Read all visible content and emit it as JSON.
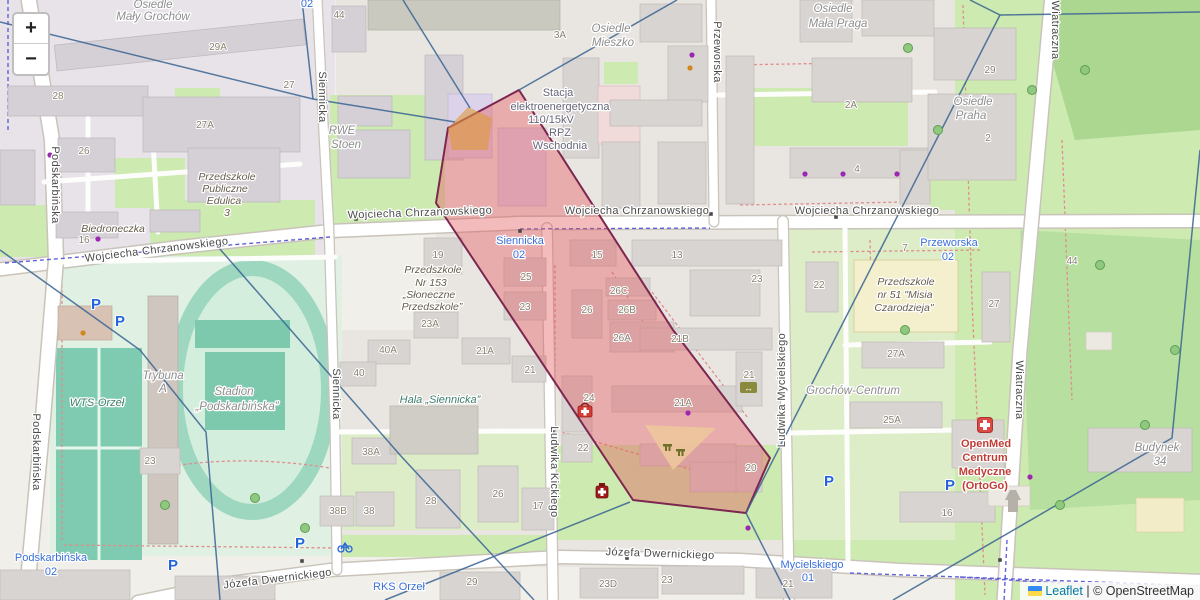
{
  "controls": {
    "zoom_in": "+",
    "zoom_out": "−"
  },
  "attribution": {
    "leaflet": "Leaflet",
    "sep": "|",
    "osm": "© OpenStreetMap"
  },
  "overlay": {
    "region_fill": "#e4555a",
    "region_stroke": "#7c2650",
    "region_opacity": "0.40",
    "region_points": "519,90 673,330 770,458 746,513 633,500 436,203 448,128",
    "orange_patch_points": "448,128 468,107 492,118 488,150 452,150",
    "orange_patch_fill": "#dd9a3a",
    "playground_points": "645,425 716,428 673,470",
    "playground_fill": "#edc79b",
    "voronoi_color": "#3e6793",
    "voronoi_lines": [
      "M302,0 L313,99",
      "M0,22 L313,99 L455,122",
      "M403,0 L470,108",
      "M677,0 L519,90",
      "M0,250 L140,350 L206,432 L220,600",
      "M212,240 L400,455 L534,600",
      "M630,502 L385,600",
      "M970,0 L1000,15 L1200,12",
      "M1000,15 L746,513",
      "M746,513 L790,600",
      "M1200,150 L1172,438 L893,600"
    ]
  },
  "map": {
    "labels": [
      {
        "t": "Wojciecha Chrzanowskiego",
        "x": 157,
        "y": 253,
        "c": "street",
        "r": -7
      },
      {
        "t": "Wojciecha Chrzanowskiego",
        "x": 420,
        "y": 216,
        "c": "street",
        "r": -2
      },
      {
        "t": "Wojciecha Chrzanowskiego",
        "x": 637,
        "y": 214,
        "c": "street"
      },
      {
        "t": "Wojciecha Chrzanowskiego",
        "x": 867,
        "y": 214,
        "c": "street"
      },
      {
        "t": "Józefa Dwernickiego",
        "x": 278,
        "y": 582,
        "c": "street",
        "r": -7
      },
      {
        "t": "Józefa Dwernickiego",
        "x": 660,
        "y": 557,
        "c": "street",
        "r": 2
      },
      {
        "t": "Podskarbińska",
        "x": 52,
        "y": 185,
        "c": "street",
        "r": 90
      },
      {
        "t": "Podskarbińska",
        "x": 33,
        "y": 452,
        "c": "street",
        "r": 90
      },
      {
        "t": "Siennicka",
        "x": 319,
        "y": 97,
        "c": "street",
        "r": 90
      },
      {
        "t": "Siennicka",
        "x": 333,
        "y": 394,
        "c": "street",
        "r": 90
      },
      {
        "t": "Ludwika Kickiego",
        "x": 551,
        "y": 472,
        "c": "street",
        "r": 90
      },
      {
        "t": "Ludwika Mycielskiego",
        "x": 785,
        "y": 390,
        "c": "street",
        "r": -90
      },
      {
        "t": "Przeworska",
        "x": 714,
        "y": 52,
        "c": "street",
        "r": 90
      },
      {
        "t": "Wiatraczna",
        "x": 1052,
        "y": 30,
        "c": "street",
        "r": 90
      },
      {
        "t": "Wiatraczna",
        "x": 1016,
        "y": 390,
        "c": "street",
        "r": 90
      },
      {
        "t": "Osiedle",
        "x": 153,
        "y": 8,
        "c": "area"
      },
      {
        "t": "Mały Grochów",
        "x": 153,
        "y": 20,
        "c": "area"
      },
      {
        "t": "Osiedle",
        "x": 611,
        "y": 32,
        "c": "area"
      },
      {
        "t": "Mieszko",
        "x": 613,
        "y": 46,
        "c": "area"
      },
      {
        "t": "Osiedle",
        "x": 833,
        "y": 12,
        "c": "area"
      },
      {
        "t": "Mała Praga",
        "x": 838,
        "y": 27,
        "c": "area"
      },
      {
        "t": "Osiedle",
        "x": 973,
        "y": 105,
        "c": "area"
      },
      {
        "t": "Praha",
        "x": 971,
        "y": 119,
        "c": "area"
      },
      {
        "t": "Grochów-Centrum",
        "x": 853,
        "y": 394,
        "c": "area"
      },
      {
        "t": "Trybuna",
        "x": 163,
        "y": 379,
        "c": "area"
      },
      {
        "t": "A",
        "x": 163,
        "y": 392,
        "c": "area"
      },
      {
        "t": "Budynek",
        "x": 1157,
        "y": 451,
        "c": "area"
      },
      {
        "t": "34",
        "x": 1160,
        "y": 465,
        "c": "area"
      },
      {
        "t": "RWE",
        "x": 342,
        "y": 134,
        "c": "area"
      },
      {
        "t": "Stoen",
        "x": 346,
        "y": 148,
        "c": "area"
      },
      {
        "t": "Stadion",
        "x": 234,
        "y": 395,
        "c": "area"
      },
      {
        "t": "„Podskarbińska”",
        "x": 237,
        "y": 410,
        "c": "area"
      },
      {
        "t": "Stacja",
        "x": 558,
        "y": 96,
        "c": "power"
      },
      {
        "t": "elektroenergetyczna",
        "x": 560,
        "y": 110,
        "c": "power"
      },
      {
        "t": "110/15kV",
        "x": 551,
        "y": 123,
        "c": "power"
      },
      {
        "t": "RPZ",
        "x": 560,
        "y": 136,
        "c": "power"
      },
      {
        "t": "Wschodnia",
        "x": 560,
        "y": 149,
        "c": "power"
      },
      {
        "t": "WTS-Orzeł",
        "x": 97,
        "y": 406,
        "c": "sport"
      },
      {
        "t": "Hala „Siennicka”",
        "x": 440,
        "y": 403,
        "c": "sport"
      },
      {
        "t": "Przedszkole",
        "x": 227,
        "y": 180,
        "c": "school"
      },
      {
        "t": "Publiczne",
        "x": 225,
        "y": 192,
        "c": "school"
      },
      {
        "t": "Edulica",
        "x": 224,
        "y": 204,
        "c": "school"
      },
      {
        "t": "3",
        "x": 227,
        "y": 216,
        "c": "school"
      },
      {
        "t": "Przedszkole",
        "x": 433,
        "y": 273,
        "c": "school"
      },
      {
        "t": "Nr 153",
        "x": 431,
        "y": 286,
        "c": "school"
      },
      {
        "t": "„Słoneczne",
        "x": 429,
        "y": 298,
        "c": "school"
      },
      {
        "t": "Przedszkole”",
        "x": 432,
        "y": 310,
        "c": "school"
      },
      {
        "t": "Przedszkole",
        "x": 906,
        "y": 285,
        "c": "school"
      },
      {
        "t": "nr 51 \"Misia",
        "x": 905,
        "y": 298,
        "c": "school"
      },
      {
        "t": "Czarodzieja\"",
        "x": 904,
        "y": 311,
        "c": "school"
      },
      {
        "t": "Biedroneczka",
        "x": 113,
        "y": 232,
        "c": "school"
      },
      {
        "t": "OpenMed",
        "x": 986,
        "y": 447,
        "c": "med"
      },
      {
        "t": "Centrum",
        "x": 985,
        "y": 461,
        "c": "med"
      },
      {
        "t": "Medyczne",
        "x": 985,
        "y": 475,
        "c": "med"
      },
      {
        "t": "(OrtoGo)",
        "x": 985,
        "y": 489,
        "c": "med"
      },
      {
        "t": "02",
        "x": 307,
        "y": 7,
        "c": "transit"
      },
      {
        "t": "Siennicka",
        "x": 520,
        "y": 244,
        "c": "transit"
      },
      {
        "t": "02",
        "x": 519,
        "y": 258,
        "c": "transit"
      },
      {
        "t": "Przeworska",
        "x": 949,
        "y": 246,
        "c": "transit"
      },
      {
        "t": "02",
        "x": 948,
        "y": 260,
        "c": "transit"
      },
      {
        "t": "Podskarbińska",
        "x": 51,
        "y": 561,
        "c": "transit"
      },
      {
        "t": "02",
        "x": 51,
        "y": 575,
        "c": "transit"
      },
      {
        "t": "Mycielskiego",
        "x": 812,
        "y": 568,
        "c": "transit"
      },
      {
        "t": "01",
        "x": 808,
        "y": 581,
        "c": "transit"
      },
      {
        "t": "RKS Orzeł",
        "x": 399,
        "y": 590,
        "c": "transit"
      },
      {
        "t": "29A",
        "x": 218,
        "y": 50,
        "c": "num"
      },
      {
        "t": "28",
        "x": 58,
        "y": 99,
        "c": "num"
      },
      {
        "t": "27A",
        "x": 205,
        "y": 128,
        "c": "num"
      },
      {
        "t": "26",
        "x": 84,
        "y": 154,
        "c": "num"
      },
      {
        "t": "27",
        "x": 289,
        "y": 88,
        "c": "num"
      },
      {
        "t": "16",
        "x": 84,
        "y": 243,
        "c": "num"
      },
      {
        "t": "44",
        "x": 339,
        "y": 18,
        "c": "num"
      },
      {
        "t": "3A",
        "x": 560,
        "y": 38,
        "c": "num"
      },
      {
        "t": "29",
        "x": 990,
        "y": 73,
        "c": "num"
      },
      {
        "t": "2A",
        "x": 851,
        "y": 108,
        "c": "num"
      },
      {
        "t": "2",
        "x": 988,
        "y": 141,
        "c": "num"
      },
      {
        "t": "4",
        "x": 857,
        "y": 172,
        "c": "num"
      },
      {
        "t": "7",
        "x": 905,
        "y": 251,
        "c": "num"
      },
      {
        "t": "44",
        "x": 1072,
        "y": 264,
        "c": "num"
      },
      {
        "t": "22",
        "x": 819,
        "y": 288,
        "c": "num"
      },
      {
        "t": "27",
        "x": 994,
        "y": 307,
        "c": "num"
      },
      {
        "t": "27A",
        "x": 896,
        "y": 357,
        "c": "num"
      },
      {
        "t": "25A",
        "x": 892,
        "y": 423,
        "c": "num"
      },
      {
        "t": "16",
        "x": 947,
        "y": 516,
        "c": "num"
      },
      {
        "t": "19",
        "x": 438,
        "y": 258,
        "c": "num"
      },
      {
        "t": "15",
        "x": 597,
        "y": 258,
        "c": "num"
      },
      {
        "t": "13",
        "x": 677,
        "y": 258,
        "c": "num"
      },
      {
        "t": "23",
        "x": 757,
        "y": 282,
        "c": "num"
      },
      {
        "t": "25",
        "x": 526,
        "y": 280,
        "c": "num"
      },
      {
        "t": "23",
        "x": 525,
        "y": 310,
        "c": "num"
      },
      {
        "t": "26",
        "x": 587,
        "y": 313,
        "c": "num"
      },
      {
        "t": "26C",
        "x": 619,
        "y": 294,
        "c": "num"
      },
      {
        "t": "26B",
        "x": 627,
        "y": 313,
        "c": "num"
      },
      {
        "t": "26A",
        "x": 622,
        "y": 341,
        "c": "num"
      },
      {
        "t": "21B",
        "x": 680,
        "y": 342,
        "c": "num"
      },
      {
        "t": "21A",
        "x": 683,
        "y": 406,
        "c": "num"
      },
      {
        "t": "24",
        "x": 589,
        "y": 401,
        "c": "num"
      },
      {
        "t": "22",
        "x": 583,
        "y": 451,
        "c": "num"
      },
      {
        "t": "21",
        "x": 749,
        "y": 378,
        "c": "num"
      },
      {
        "t": "20",
        "x": 751,
        "y": 471,
        "c": "num"
      },
      {
        "t": "23A",
        "x": 430,
        "y": 327,
        "c": "num"
      },
      {
        "t": "21A",
        "x": 485,
        "y": 354,
        "c": "num"
      },
      {
        "t": "21",
        "x": 530,
        "y": 373,
        "c": "num"
      },
      {
        "t": "40A",
        "x": 388,
        "y": 353,
        "c": "num"
      },
      {
        "t": "40",
        "x": 359,
        "y": 376,
        "c": "num"
      },
      {
        "t": "38A",
        "x": 371,
        "y": 455,
        "c": "num"
      },
      {
        "t": "38B",
        "x": 338,
        "y": 514,
        "c": "num"
      },
      {
        "t": "38",
        "x": 369,
        "y": 514,
        "c": "num"
      },
      {
        "t": "23",
        "x": 150,
        "y": 464,
        "c": "num"
      },
      {
        "t": "28",
        "x": 431,
        "y": 504,
        "c": "num"
      },
      {
        "t": "26",
        "x": 498,
        "y": 497,
        "c": "num"
      },
      {
        "t": "17",
        "x": 538,
        "y": 509,
        "c": "num"
      },
      {
        "t": "29",
        "x": 472,
        "y": 585,
        "c": "num"
      },
      {
        "t": "23D",
        "x": 608,
        "y": 587,
        "c": "num"
      },
      {
        "t": "23",
        "x": 667,
        "y": 583,
        "c": "num"
      },
      {
        "t": "21",
        "x": 788,
        "y": 587,
        "c": "num"
      }
    ],
    "parking": [
      {
        "x": 96,
        "y": 309
      },
      {
        "x": 120,
        "y": 326
      },
      {
        "x": 173,
        "y": 570
      },
      {
        "x": 300,
        "y": 548
      },
      {
        "x": 829,
        "y": 486
      },
      {
        "x": 950,
        "y": 490
      }
    ],
    "dots": [
      {
        "x": 50,
        "y": 155,
        "c": "#9c27b0"
      },
      {
        "x": 98,
        "y": 239,
        "c": "#9c27b0"
      },
      {
        "x": 692,
        "y": 55,
        "c": "#9c27b0"
      },
      {
        "x": 805,
        "y": 174,
        "c": "#9c27b0"
      },
      {
        "x": 843,
        "y": 174,
        "c": "#9c27b0"
      },
      {
        "x": 897,
        "y": 174,
        "c": "#9c27b0"
      },
      {
        "x": 748,
        "y": 528,
        "c": "#9c27b0"
      },
      {
        "x": 688,
        "y": 413,
        "c": "#9c27b0"
      },
      {
        "x": 1030,
        "y": 477,
        "c": "#9c27b0"
      },
      {
        "x": 690,
        "y": 68,
        "c": "#d2861f"
      },
      {
        "x": 83,
        "y": 333,
        "c": "#d2861f"
      }
    ],
    "markers": [
      {
        "x": 356,
        "y": 219
      },
      {
        "x": 836,
        "y": 217
      },
      {
        "x": 520,
        "y": 231
      },
      {
        "x": 302,
        "y": 561
      },
      {
        "x": 711,
        "y": 214
      },
      {
        "x": 553,
        "y": 432
      },
      {
        "x": 1000,
        "y": 560
      },
      {
        "x": 627,
        "y": 558
      }
    ],
    "trees": [
      {
        "x": 908,
        "y": 48
      },
      {
        "x": 938,
        "y": 130
      },
      {
        "x": 905,
        "y": 330
      },
      {
        "x": 1085,
        "y": 70
      },
      {
        "x": 1100,
        "y": 265
      },
      {
        "x": 1145,
        "y": 425
      },
      {
        "x": 1060,
        "y": 505
      },
      {
        "x": 1175,
        "y": 350
      },
      {
        "x": 1032,
        "y": 90
      },
      {
        "x": 165,
        "y": 505
      },
      {
        "x": 255,
        "y": 498
      },
      {
        "x": 305,
        "y": 528
      }
    ]
  }
}
